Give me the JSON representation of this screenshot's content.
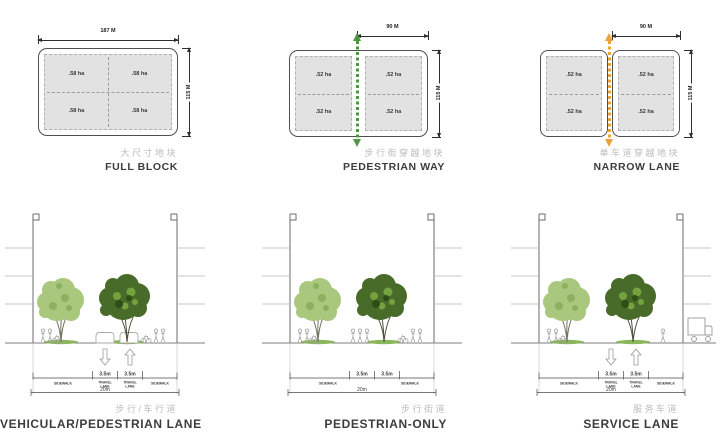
{
  "blocks": [
    {
      "caption_cn": "大尺寸地块",
      "caption_en": "FULL BLOCK",
      "width_label": "187 M",
      "height_label": "115 M",
      "quadrants": [
        ".58 ha",
        ".58 ha",
        ".58 ha",
        ".58 ha"
      ]
    },
    {
      "caption_cn": "步行街穿越地块",
      "caption_en": "PEDESTRIAN WAY",
      "width_label": "90 M",
      "height_label": "115 M",
      "quadrants": [
        ".52 ha",
        ".52 ha",
        ".52 ha",
        ".52 ha"
      ],
      "lane_color": "#4e9544"
    },
    {
      "caption_cn": "单车道穿越地块",
      "caption_en": "NARROW LANE",
      "width_label": "90 M",
      "height_label": "115 M",
      "quadrants": [
        ".52 ha",
        ".52 ha",
        ".52 ha",
        ".52 ha"
      ],
      "lane_color": "#e8a33c"
    }
  ],
  "sections": [
    {
      "caption_cn": "步行/车行道",
      "caption_en": "VEHICULAR/PEDESTRIAN LANE",
      "lane1_width": "3.5m",
      "lane2_width": "3.5m",
      "total_width": "20m",
      "sidewalk_left": "SIDEWALK",
      "sidewalk_right": "SIDEWALK",
      "lane1_label_top": "TRAVEL",
      "lane1_label_bottom": "LANE",
      "lane2_label_top": "TRAVEL",
      "lane2_label_bottom": "LANE"
    },
    {
      "caption_cn": "步行街道",
      "caption_en": "PEDESTRIAN-ONLY",
      "lane1_width": "3.5m",
      "lane2_width": "3.5m",
      "total_width": "20m",
      "sidewalk_left": "SIDEWALK",
      "sidewalk_right": "SIDEWALK",
      "lane1_label_top": "",
      "lane1_label_bottom": "",
      "lane2_label_top": "",
      "lane2_label_bottom": ""
    },
    {
      "caption_cn": "服务车道",
      "caption_en": "SERVICE LANE",
      "lane1_width": "3.5m",
      "lane2_width": "3.5m",
      "total_width": "20m",
      "sidewalk_left": "SIDEWALK",
      "sidewalk_right": "SIDEWALK",
      "lane1_label_top": "TRAVEL",
      "lane1_label_bottom": "LANE",
      "lane2_label_top": "TRAVEL",
      "lane2_label_bottom": "LANE"
    }
  ],
  "colors": {
    "block_fill": "#e2e2e2",
    "pedestrian_way_green": "#4e9544",
    "narrow_lane_orange": "#e8a33c",
    "caption_cn_gray": "#bcbcbc",
    "caption_en_dark": "#3d3d3d",
    "tree_light_green": "#a9c87d",
    "tree_dark_green": "#486b2a"
  }
}
